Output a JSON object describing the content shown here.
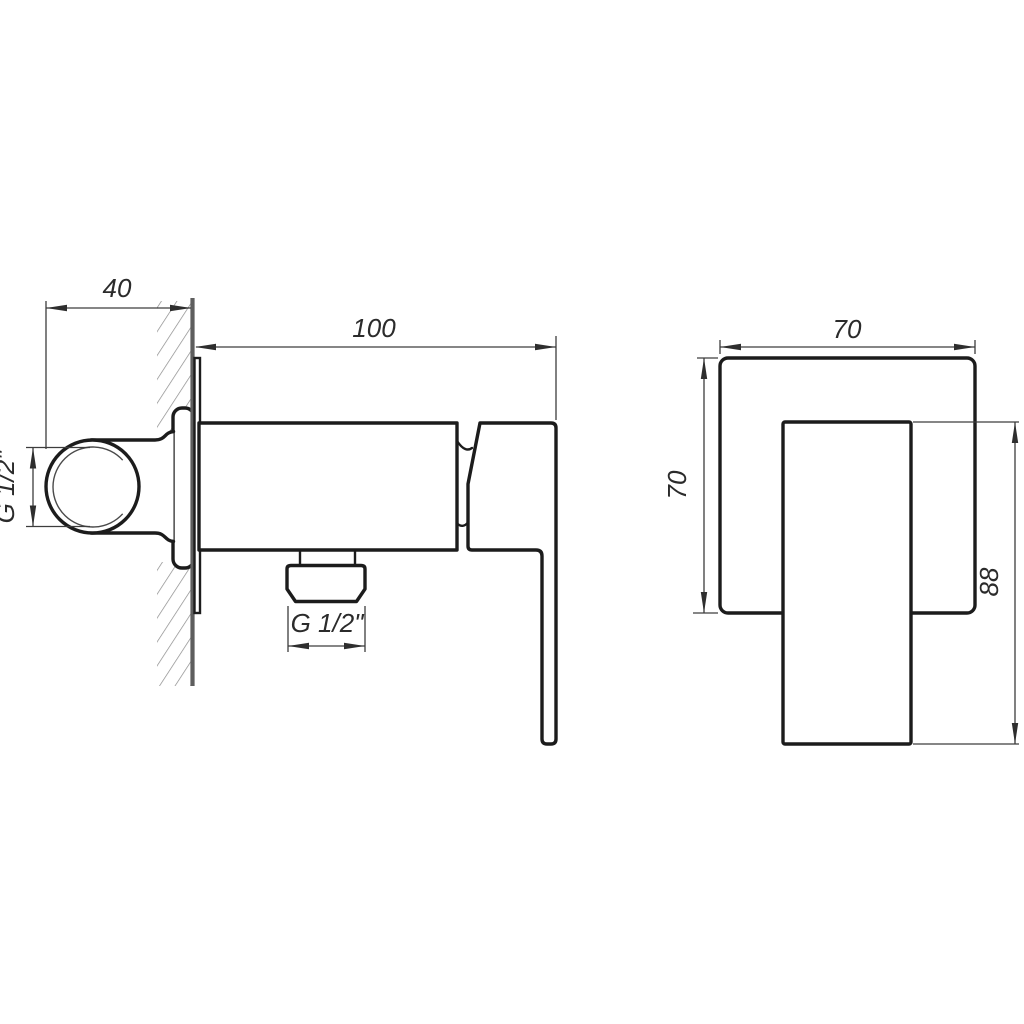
{
  "drawing": {
    "kind": "technical-dimension-drawing",
    "subject": "wall-mounted single-lever mixer tap, side view and front view",
    "views": {
      "side": "side-section-view",
      "front": "front-view"
    },
    "dimensions": {
      "wall_offset": "40",
      "body_length": "100",
      "inlet_thread": "G 1/2\"",
      "outlet_thread": "G 1/2\"",
      "plate_width": "70",
      "plate_height": "70",
      "handle_height": "88"
    },
    "colors": {
      "background": "#ffffff",
      "outline": "#1c1c1c",
      "dimension_lines": "#3d3d3d",
      "wall_line": "#5e5e5e",
      "hatch": "#8a8a8a"
    }
  }
}
